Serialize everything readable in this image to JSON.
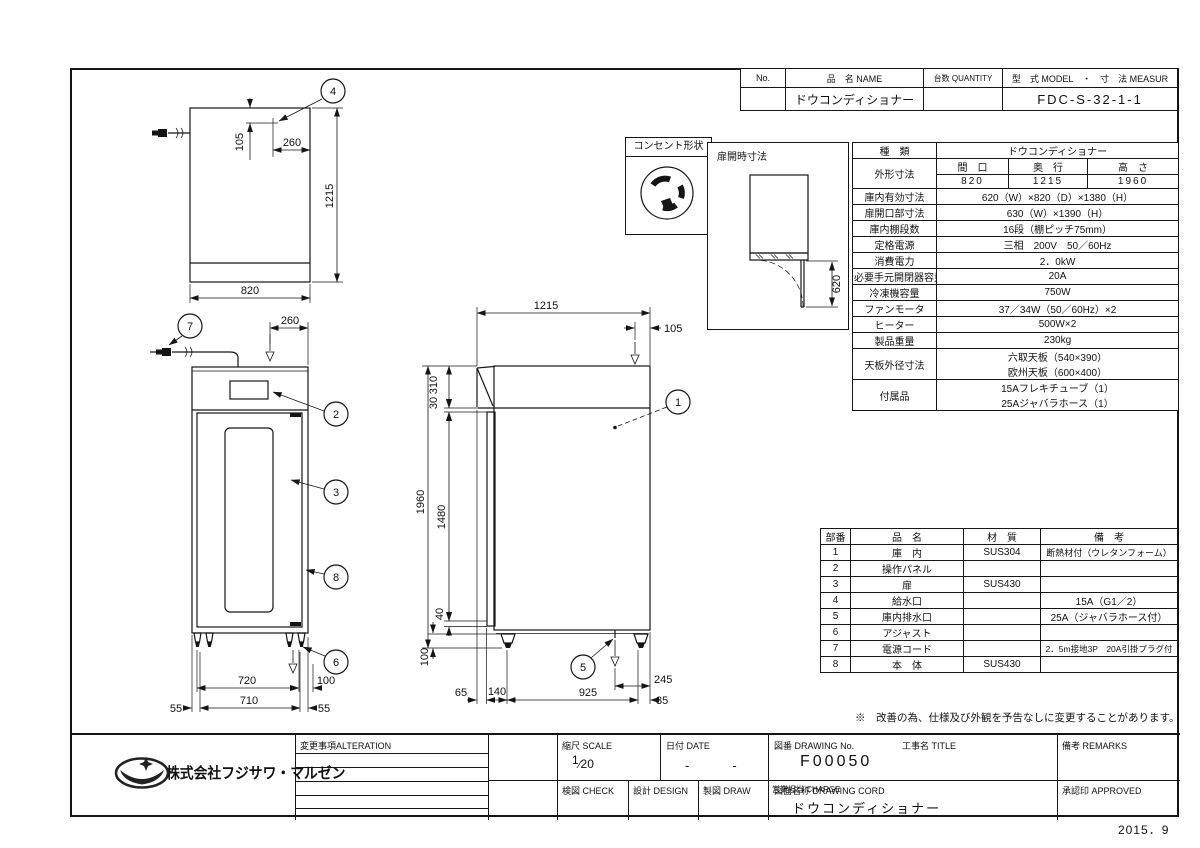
{
  "nameplate": {
    "no_label": "No.",
    "name_label": "品　名 NAME",
    "qty_label": "台数 QUANTITY",
    "model_label": "型　式 MODEL　・　寸　法 MEASUR",
    "name": "ドウコンディショナー",
    "model": "FDC-S-32-1-1"
  },
  "outlet_box": {
    "title": "コンセント形状"
  },
  "door_open_box": {
    "title": "扉開時寸法",
    "dim": "620"
  },
  "spec": {
    "kind_label": "種　類",
    "kind_value": "ドウコンディショナー",
    "outer_label": "外形寸法",
    "w_label": "間　口",
    "d_label": "奥　行",
    "h_label": "高　さ",
    "w": "820",
    "d": "1215",
    "h": "1960",
    "items": [
      {
        "label": "庫内有効寸法",
        "value": "620（W）×820（D）×1380（H）"
      },
      {
        "label": "扉開口部寸法",
        "value": "630（W）×1390（H）"
      },
      {
        "label": "庫内棚段数",
        "value": "16段（棚ピッチ75mm）"
      },
      {
        "label": "定格電源",
        "value": "三相　200V　50／60Hz"
      },
      {
        "label": "消費電力",
        "value": "2．0kW"
      },
      {
        "label": "必要手元開閉器容量",
        "value": "20A"
      },
      {
        "label": "冷凍機容量",
        "value": "750W"
      },
      {
        "label": "ファンモータ",
        "value": "37／34W（50／60Hz）×2"
      },
      {
        "label": "ヒーター",
        "value": "500W×2"
      },
      {
        "label": "製品重量",
        "value": "230kg"
      },
      {
        "label": "天板外径寸法",
        "line1": "六取天板（540×390）",
        "line2": "欧州天板（600×400）"
      },
      {
        "label": "付属品",
        "line1": "15Aフレキチューブ（1）",
        "line2": "25Aジャバラホース（1）"
      }
    ]
  },
  "parts": {
    "headers": [
      "部番",
      "品　名",
      "材　質",
      "備　考"
    ],
    "rows": [
      [
        "1",
        "庫　内",
        "SUS304",
        "断熱材付（ウレタンフォーム）"
      ],
      [
        "2",
        "操作パネル",
        "",
        ""
      ],
      [
        "3",
        "扉",
        "SUS430",
        ""
      ],
      [
        "4",
        "給水口",
        "",
        "15A（G1／2）"
      ],
      [
        "5",
        "庫内排水口",
        "",
        "25A（ジャバラホース付）"
      ],
      [
        "6",
        "アジャスト",
        "",
        ""
      ],
      [
        "7",
        "電源コード",
        "",
        "2．5m接地3P　20A引掛プラグ付"
      ],
      [
        "8",
        "本　体",
        "SUS430",
        ""
      ]
    ]
  },
  "note": "※　改善の為、仕様及び外観を予告なしに変更することがあります。",
  "titleblock": {
    "company": "株式会社フジサワ・マルゼン",
    "alteration_label": "変更事項ALTERATION",
    "scale_label": "縮尺 SCALE",
    "scale_num": "1",
    "scale_slash": "⁄",
    "scale_den": "20",
    "date_label": "日付 DATE",
    "date_value": "-　　　-",
    "dwgno_label": "図番 DRAWING  No.",
    "dwgno_value": "F00050",
    "title_label": "工事名 TITLE",
    "remarks_label": "備考 REMARKS",
    "check_label": "検図 CHECK",
    "design_label": "設計 DESIGN",
    "draw_label": "製図 DRAW",
    "charge_label": "営業担当 CHARGE",
    "dwgname_label": "図面名称 DRAWING  CORD",
    "dwgname_value": "ドウコンディショナー",
    "approved_label": "承認印 APPROVED",
    "date_stamp": "2015．9"
  },
  "dims": {
    "v105": "105",
    "v260": "260",
    "v1215": "1215",
    "v820": "820",
    "v720": "720",
    "v710": "710",
    "v55": "55",
    "v100": "100",
    "v1960": "1960",
    "v1480": "1480",
    "v310": "310",
    "v30": "30",
    "v40": "40",
    "v65": "65",
    "v140": "140",
    "v925": "925",
    "v245": "245",
    "v85": "85",
    "v620": "620"
  },
  "balloons": {
    "b1": "1",
    "b2": "2",
    "b3": "3",
    "b4": "4",
    "b5": "5",
    "b6": "6",
    "b7": "7",
    "b8": "8"
  }
}
